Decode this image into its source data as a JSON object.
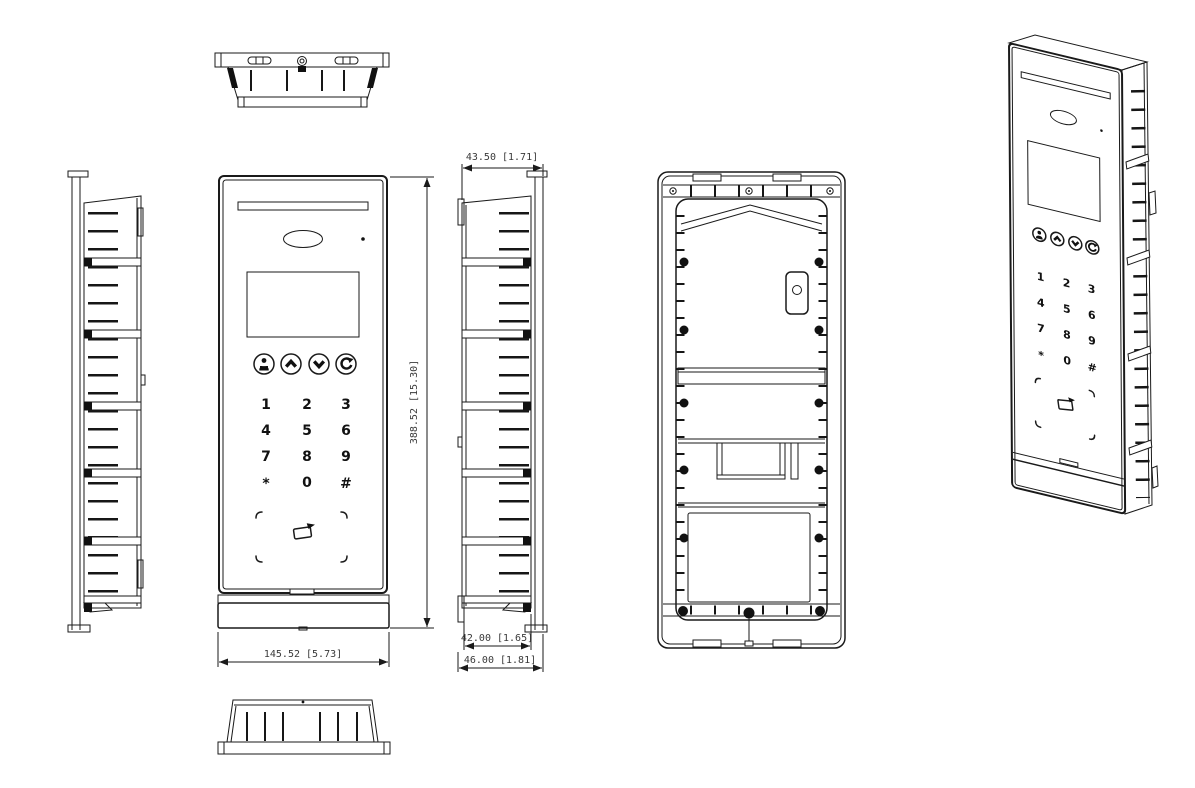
{
  "drawing": {
    "dimensions": {
      "front_width": "145.52 [5.73]",
      "front_height": "388.52 [15.30]",
      "side_depth_top": "43.50 [1.71]",
      "side_depth_body": "42.00 [1.65]",
      "side_depth_overall": "46.00 [1.81]"
    },
    "keypad": {
      "keys": [
        "1",
        "2",
        "3",
        "4",
        "5",
        "6",
        "7",
        "8",
        "9",
        "*",
        "0",
        "#"
      ]
    },
    "icons": {
      "nav": [
        "directory-icon",
        "arrow-up-icon",
        "arrow-down-icon",
        "call-icon"
      ],
      "card_reader": "card-swipe-icon"
    },
    "colors": {
      "line": "#1a1a1a",
      "fill_dark": "#111111",
      "background": "#ffffff"
    }
  }
}
